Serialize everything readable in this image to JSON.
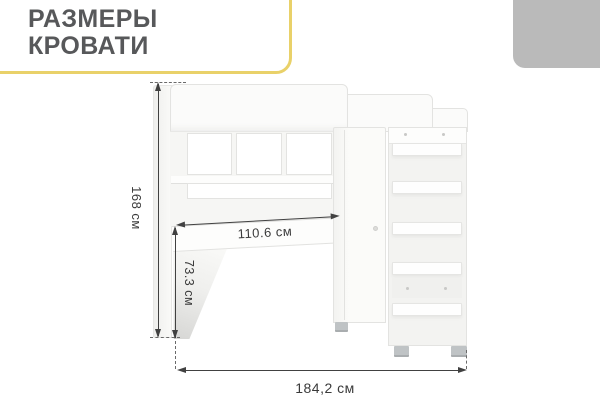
{
  "title": {
    "line1": "РАЗМЕРЫ",
    "line2": "КРОВАТИ"
  },
  "diagram": {
    "height_label": "168 см",
    "desk_width_label": "110.6 см",
    "desk_height_label": "73.3 см",
    "total_width_label": "184,2 см"
  },
  "colors": {
    "accent_yellow": "#e9d169",
    "corner_tab_gray": "#bababa",
    "title_text": "#57585a",
    "dimension_line": "#414141",
    "dimension_text": "#3a3a3a",
    "furniture_outline": "#e3e3e1",
    "furniture_fill": "#fbfbfa",
    "foot_gray": "#bfc3c5"
  }
}
